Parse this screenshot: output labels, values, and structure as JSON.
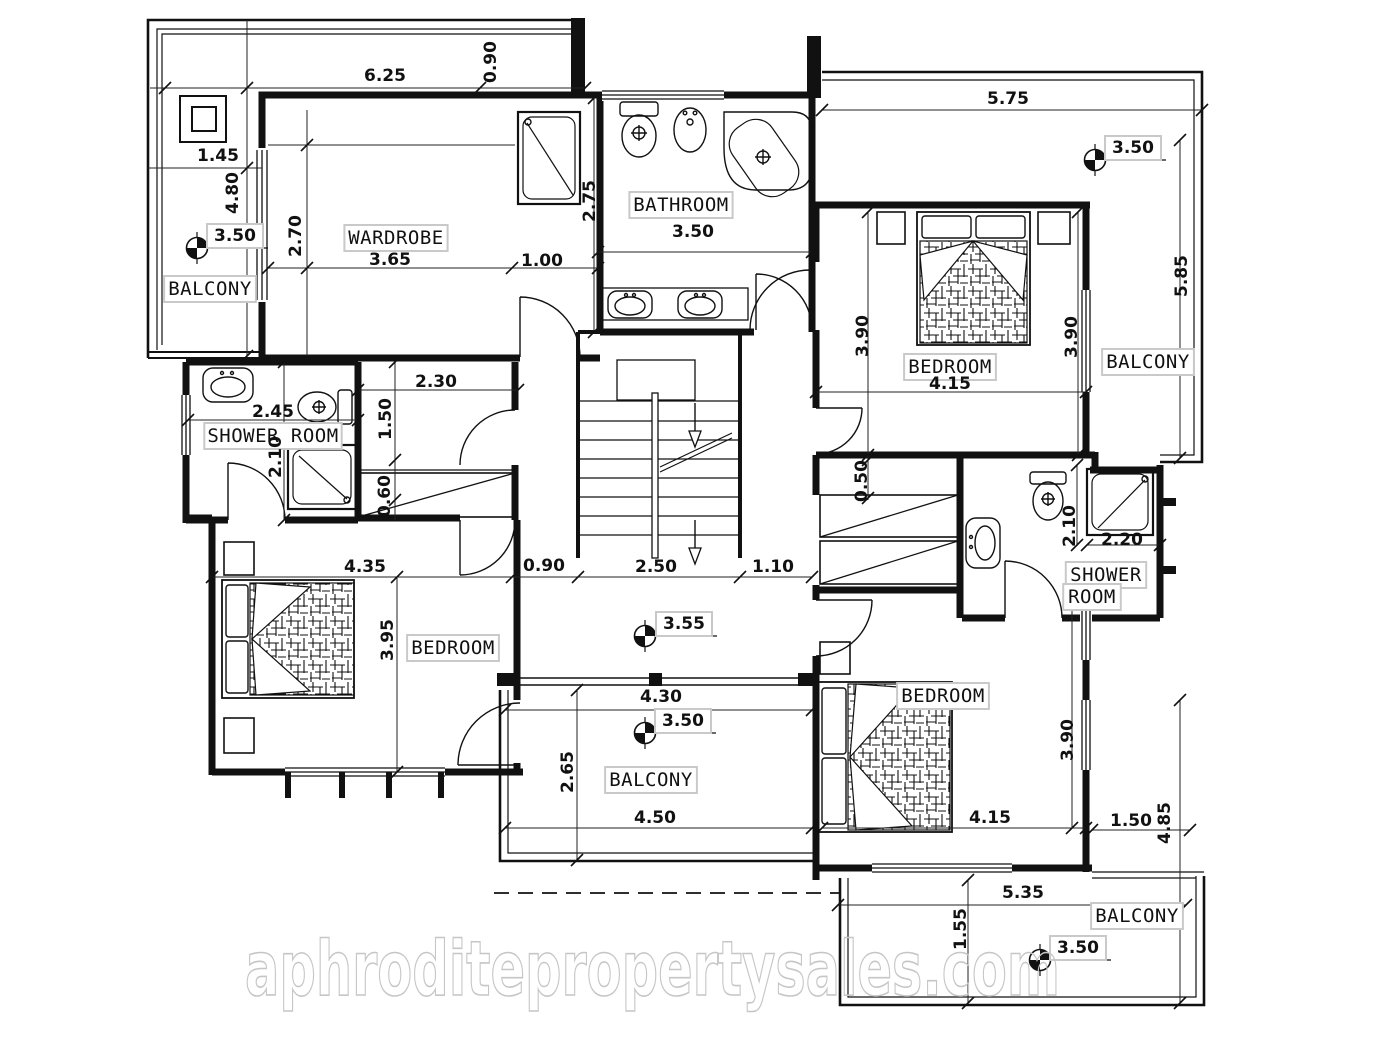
{
  "watermark": {
    "text": "aphroditepropertysales.com"
  },
  "plan": {
    "rooms": [
      {
        "name": "BALCONY",
        "x": 210,
        "y": 289
      },
      {
        "name": "WARDROBE",
        "x": 396,
        "y": 238
      },
      {
        "name": "BATHROOM",
        "x": 681,
        "y": 205
      },
      {
        "name": "BEDROOM",
        "x": 950,
        "y": 367
      },
      {
        "name": "BALCONY",
        "x": 1148,
        "y": 362
      },
      {
        "name": "SHOWER ROOM",
        "x": 273,
        "y": 436
      },
      {
        "name": "BEDROOM",
        "x": 453,
        "y": 648
      },
      {
        "name": "BALCONY",
        "x": 651,
        "y": 780
      },
      {
        "name": "BEDROOM",
        "x": 943,
        "y": 696
      },
      {
        "name": "SHOWER",
        "x": 1106,
        "y": 575
      },
      {
        "name": "ROOM",
        "x": 1092,
        "y": 597
      },
      {
        "name": "BALCONY",
        "x": 1137,
        "y": 916
      }
    ],
    "dimensions": [
      {
        "text": "6.25",
        "x": 385,
        "y": 76
      },
      {
        "text": "0.90",
        "x": 491,
        "y": 62,
        "rot": true
      },
      {
        "text": "1.45",
        "x": 218,
        "y": 156
      },
      {
        "text": "4.80",
        "x": 233,
        "y": 193,
        "rot": true
      },
      {
        "text": "2.70",
        "x": 296,
        "y": 236,
        "rot": true
      },
      {
        "text": "3.65",
        "x": 390,
        "y": 260
      },
      {
        "text": "1.00",
        "x": 542,
        "y": 261
      },
      {
        "text": "2.75",
        "x": 590,
        "y": 201,
        "rot": true
      },
      {
        "text": "3.50",
        "x": 693,
        "y": 232
      },
      {
        "text": "5.75",
        "x": 1008,
        "y": 99
      },
      {
        "text": "5.85",
        "x": 1182,
        "y": 276,
        "rot": true
      },
      {
        "text": "3.90",
        "x": 863,
        "y": 336,
        "rot": true
      },
      {
        "text": "3.90",
        "x": 1072,
        "y": 337,
        "rot": true
      },
      {
        "text": "4.15",
        "x": 950,
        "y": 384
      },
      {
        "text": "2.45",
        "x": 273,
        "y": 412
      },
      {
        "text": "2.10",
        "x": 276,
        "y": 457,
        "rot": true
      },
      {
        "text": "2.30",
        "x": 436,
        "y": 382
      },
      {
        "text": "1.50",
        "x": 386,
        "y": 419,
        "rot": true
      },
      {
        "text": "0.60",
        "x": 385,
        "y": 496,
        "rot": true
      },
      {
        "text": "4.35",
        "x": 365,
        "y": 567
      },
      {
        "text": "0.90",
        "x": 544,
        "y": 566
      },
      {
        "text": "2.50",
        "x": 656,
        "y": 567
      },
      {
        "text": "1.10",
        "x": 773,
        "y": 567
      },
      {
        "text": "0.50",
        "x": 862,
        "y": 481,
        "rot": true
      },
      {
        "text": "2.10",
        "x": 1070,
        "y": 526,
        "rot": true
      },
      {
        "text": "2.20",
        "x": 1122,
        "y": 540
      },
      {
        "text": "3.95",
        "x": 388,
        "y": 640,
        "rot": true
      },
      {
        "text": "4.30",
        "x": 661,
        "y": 697
      },
      {
        "text": "2.65",
        "x": 568,
        "y": 772,
        "rot": true
      },
      {
        "text": "4.50",
        "x": 655,
        "y": 818
      },
      {
        "text": "4.15",
        "x": 990,
        "y": 818
      },
      {
        "text": "3.90",
        "x": 1068,
        "y": 740,
        "rot": true
      },
      {
        "text": "5.35",
        "x": 1023,
        "y": 893
      },
      {
        "text": "1.50",
        "x": 1131,
        "y": 821
      },
      {
        "text": "4.85",
        "x": 1165,
        "y": 823,
        "rot": true
      },
      {
        "text": "1.55",
        "x": 961,
        "y": 929,
        "rot": true
      }
    ],
    "elevations": [
      {
        "value": "3.50",
        "x": 197,
        "y": 248,
        "lx": 235,
        "ly": 236
      },
      {
        "value": "3.50",
        "x": 1095,
        "y": 160,
        "lx": 1133,
        "ly": 148
      },
      {
        "value": "3.55",
        "x": 645,
        "y": 636,
        "lx": 684,
        "ly": 624
      },
      {
        "value": "3.50",
        "x": 645,
        "y": 733,
        "lx": 683,
        "ly": 721
      },
      {
        "value": "3.50",
        "x": 1040,
        "y": 960,
        "lx": 1078,
        "ly": 948
      }
    ]
  }
}
